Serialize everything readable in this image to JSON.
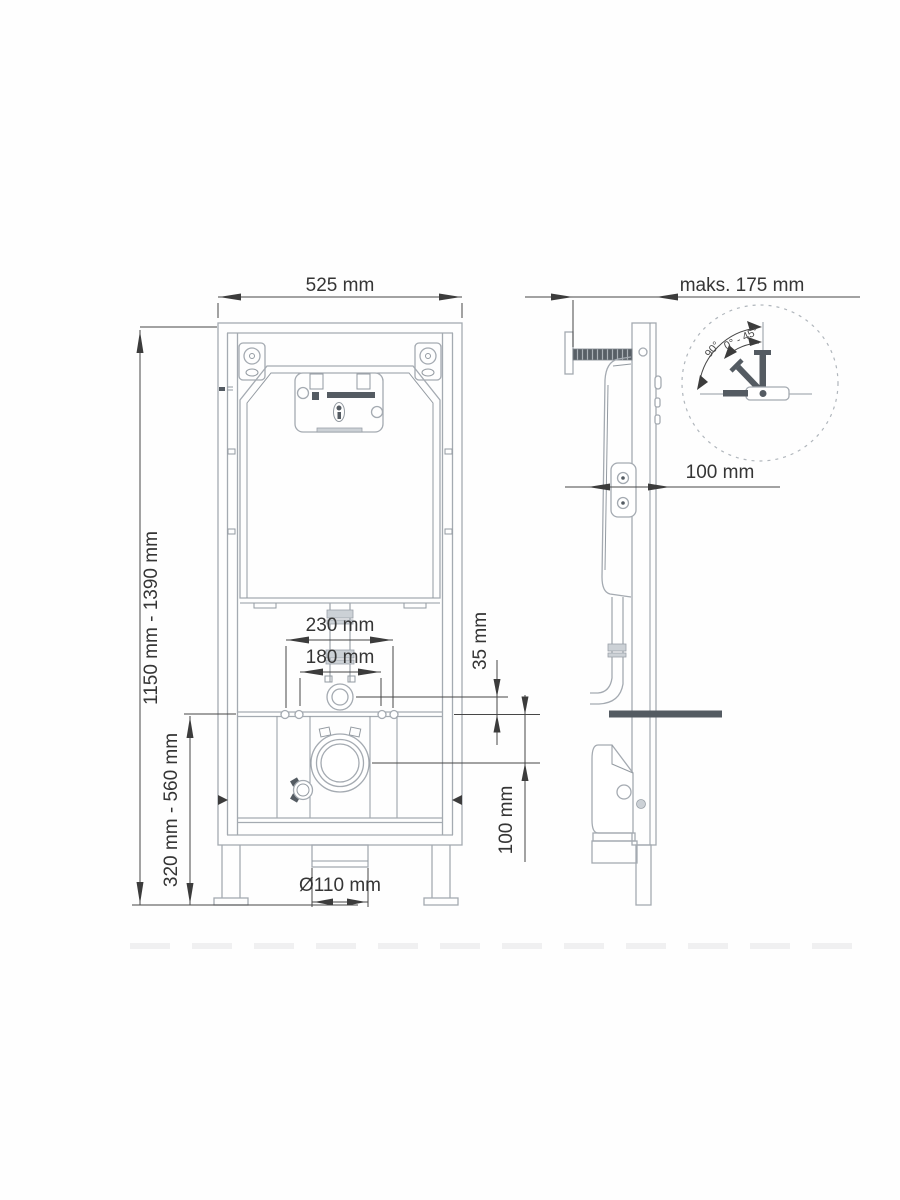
{
  "drawing": {
    "type": "technical-installation-drawing",
    "subject": "concealed-cistern-wc-frame"
  },
  "colors": {
    "background": "#fefefe",
    "drawing_line": "#a4aab1",
    "dark_part": "#545b62",
    "dimension": "#3c3c3c"
  },
  "dimensions": {
    "width_front": "525 mm",
    "depth_max": "maks. 175 mm",
    "height_range": "1150 mm - 1390 mm",
    "mount_height_range": "320 mm - 560 mm",
    "rod_spacing_outer": "230 mm",
    "rod_spacing_inner": "180 mm",
    "flush_pipe_offset": "35 mm",
    "drain_offset": "100 mm",
    "wall_clearance": "100 mm",
    "drain_diameter": "Ø110 mm"
  },
  "detail": {
    "angle_max": "90°",
    "angle_range": "0° - 45°"
  }
}
